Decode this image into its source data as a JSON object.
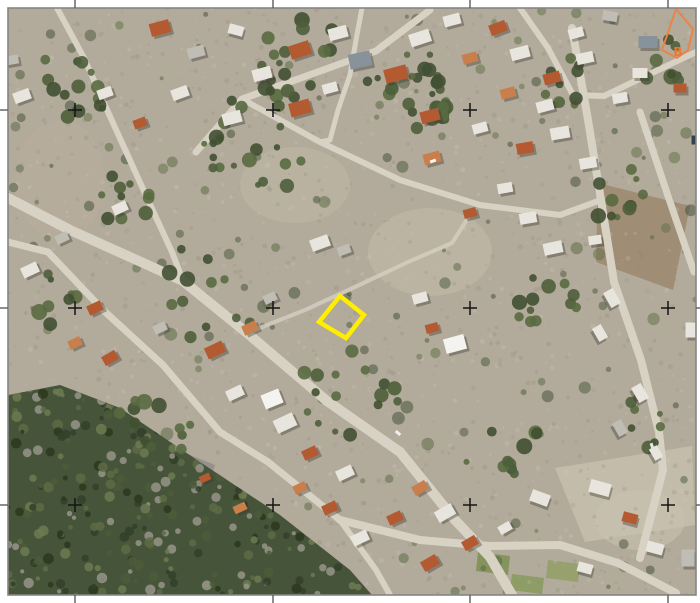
{
  "canvas": {
    "width": 700,
    "height": 603,
    "background": "#ffffff"
  },
  "frame": {
    "x": 8,
    "y": 8,
    "width": 688,
    "height": 587,
    "border_color": "#858585",
    "border_width": 1.6,
    "tick_color": "#5c5c5c",
    "tick_width": 1.4,
    "tick_len": 8
  },
  "grid": {
    "cross_color": "#151515",
    "cross_half": 7,
    "cross_width": 1.5,
    "xs": [
      75,
      273,
      470,
      668
    ],
    "ys": [
      110,
      308,
      505
    ]
  },
  "overlays": {
    "parcel": {
      "points": [
        [
          340,
          296
        ],
        [
          364,
          315
        ],
        [
          346,
          338
        ],
        [
          319,
          322
        ]
      ],
      "color": "#ffee00",
      "stroke_width": 4.5
    },
    "zone": {
      "points": [
        [
          676,
          9
        ],
        [
          693,
          29
        ],
        [
          688,
          50
        ],
        [
          677,
          58
        ],
        [
          662,
          50
        ]
      ],
      "color": "#ee8240",
      "stroke_width": 2,
      "label": "B",
      "label_x": 678,
      "label_y": 56,
      "label_color": "#e87a30",
      "label_size": 12
    }
  },
  "palette": {
    "terrain": "#b2aa9a",
    "road": "#d8d2c4",
    "forest": "#46543a",
    "tree_greens": [
      "#4e5e3b",
      "#415032",
      "#596a40"
    ],
    "shadow": "#3c3c34",
    "roofs": {
      "orange": "#b45a31",
      "orange2": "#c97f4b",
      "white": "#e7e5de",
      "white_bright": "#f4f3ef",
      "gray": "#bfbdb4",
      "gray_blue": "#87929b",
      "dark": "#6e6e68"
    }
  },
  "texture": {
    "ground": {
      "seed": 11,
      "count": 1500,
      "rmin": 0.7,
      "rmax": 2.6,
      "opacity": 0.22,
      "colors": [
        "#97907e",
        "#cdc7b8",
        "#8b8470",
        "#d6d0c2",
        "#7d8a68"
      ]
    },
    "greens": {
      "seed": 23,
      "count": 170,
      "rmin": 2,
      "rmax": 6.5,
      "opacity": 0.5,
      "colors": [
        "#55663f",
        "#47573a",
        "#5f7046",
        "#3e4c33"
      ]
    },
    "forest": {
      "seed": 5,
      "count": 420,
      "rmin": 2,
      "rmax": 5.5,
      "opacity": 0.85,
      "colors": [
        "#33402a",
        "#4c5c3a",
        "#5d6b45",
        "#97948a",
        "#2b381f",
        "#6d7b52"
      ]
    }
  },
  "forest_polygon": [
    [
      8,
      395
    ],
    [
      60,
      385
    ],
    [
      120,
      408
    ],
    [
      200,
      462
    ],
    [
      280,
      515
    ],
    [
      350,
      570
    ],
    [
      372,
      595
    ],
    [
      8,
      595
    ]
  ],
  "forest_bbox": [
    8,
    380,
    380,
    595
  ],
  "fields": [
    {
      "type": "ellipse",
      "cx": 60,
      "cy": 180,
      "rx": 45,
      "ry": 60,
      "fill": "#b7ae9c",
      "op": 0.5
    },
    {
      "type": "ellipse",
      "cx": 295,
      "cy": 185,
      "rx": 55,
      "ry": 38,
      "fill": "#c1b9a7",
      "op": 0.5
    },
    {
      "type": "ellipse",
      "cx": 430,
      "cy": 252,
      "rx": 62,
      "ry": 44,
      "fill": "#c3bbaa",
      "op": 0.55
    },
    {
      "type": "poly",
      "pts": [
        [
          598,
          183
        ],
        [
          690,
          206
        ],
        [
          673,
          290
        ],
        [
          596,
          262
        ]
      ],
      "fill": "#9d8a72",
      "op": 0.9
    },
    {
      "type": "poly",
      "pts": [
        [
          555,
          468
        ],
        [
          692,
          446
        ],
        [
          695,
          525
        ],
        [
          585,
          542
        ]
      ],
      "fill": "#c6bfae",
      "op": 0.85
    },
    {
      "type": "ellipse",
      "cx": 640,
      "cy": 520,
      "rx": 45,
      "ry": 30,
      "fill": "#c9c2b1",
      "op": 0.6
    },
    {
      "type": "poly",
      "pts": [
        [
          120,
          427
        ],
        [
          215,
          465
        ],
        [
          185,
          555
        ],
        [
          95,
          515
        ]
      ],
      "fill": "#5d6670",
      "op": 0.35
    },
    {
      "type": "poly",
      "pts": [
        [
          478,
          552
        ],
        [
          510,
          556
        ],
        [
          508,
          575
        ],
        [
          476,
          571
        ]
      ],
      "fill": "#7f9158",
      "op": 0.9
    },
    {
      "type": "poly",
      "pts": [
        [
          512,
          574
        ],
        [
          544,
          578
        ],
        [
          542,
          594
        ],
        [
          510,
          590
        ]
      ],
      "fill": "#8a9a60",
      "op": 0.9
    },
    {
      "type": "poly",
      "pts": [
        [
          548,
          560
        ],
        [
          580,
          564
        ],
        [
          578,
          582
        ],
        [
          546,
          578
        ]
      ],
      "fill": "#90a066",
      "op": 0.85
    }
  ],
  "roads": [
    {
      "pts": [
        [
          8,
          198
        ],
        [
          70,
          230
        ],
        [
          130,
          257
        ],
        [
          183,
          281
        ],
        [
          247,
          333
        ],
        [
          327,
          401
        ],
        [
          400,
          452
        ],
        [
          455,
          520
        ],
        [
          490,
          557
        ],
        [
          512,
          595
        ]
      ],
      "w": 10
    },
    {
      "pts": [
        [
          8,
          242
        ],
        [
          48,
          252
        ],
        [
          103,
          310
        ],
        [
          163,
          365
        ],
        [
          220,
          432
        ],
        [
          268,
          462
        ],
        [
          340,
          520
        ]
      ],
      "w": 7
    },
    {
      "pts": [
        [
          340,
          520
        ],
        [
          420,
          540
        ],
        [
          490,
          546
        ],
        [
          560,
          545
        ],
        [
          618,
          563
        ],
        [
          676,
          593
        ]
      ],
      "w": 8
    },
    {
      "pts": [
        [
          340,
          520
        ],
        [
          376,
          570
        ],
        [
          390,
          595
        ]
      ],
      "w": 6
    },
    {
      "pts": [
        [
          196,
          152
        ],
        [
          242,
          99
        ],
        [
          312,
          74
        ],
        [
          376,
          51
        ],
        [
          430,
          10
        ]
      ],
      "w": 7
    },
    {
      "pts": [
        [
          57,
          8
        ],
        [
          84,
          58
        ],
        [
          108,
          112
        ],
        [
          148,
          200
        ],
        [
          172,
          252
        ],
        [
          183,
          281
        ]
      ],
      "w": 6
    },
    {
      "pts": [
        [
          572,
          28
        ],
        [
          588,
          120
        ],
        [
          601,
          200
        ],
        [
          614,
          282
        ],
        [
          641,
          360
        ],
        [
          659,
          432
        ],
        [
          663,
          470
        ],
        [
          650,
          520
        ],
        [
          640,
          558
        ]
      ],
      "w": 8
    },
    {
      "pts": [
        [
          640,
          112
        ],
        [
          668,
          196
        ],
        [
          694,
          272
        ]
      ],
      "w": 7
    },
    {
      "pts": [
        [
          604,
          96
        ],
        [
          654,
          72
        ],
        [
          696,
          52
        ]
      ],
      "w": 6
    },
    {
      "pts": [
        [
          520,
          8
        ],
        [
          548,
          48
        ],
        [
          573,
          95
        ],
        [
          604,
          96
        ]
      ],
      "w": 6
    },
    {
      "pts": [
        [
          242,
          99
        ],
        [
          320,
          142
        ],
        [
          400,
          180
        ],
        [
          480,
          205
        ],
        [
          560,
          215
        ],
        [
          601,
          200
        ]
      ],
      "w": 6
    },
    {
      "pts": [
        [
          247,
          333
        ],
        [
          305,
          310
        ],
        [
          355,
          287
        ],
        [
          408,
          262
        ],
        [
          452,
          243
        ],
        [
          470,
          215
        ]
      ],
      "w": 4,
      "o": 0.75
    },
    {
      "pts": [
        [
          362,
          8
        ],
        [
          356,
          40
        ],
        [
          350,
          75
        ],
        [
          338,
          110
        ],
        [
          330,
          140
        ],
        [
          320,
          142
        ]
      ],
      "w": 5
    }
  ],
  "tree_clusters": [
    {
      "x": 250,
      "y": 135,
      "n": 26,
      "s": 95
    },
    {
      "x": 420,
      "y": 95,
      "n": 22,
      "s": 85
    },
    {
      "x": 80,
      "y": 80,
      "n": 14,
      "s": 75
    },
    {
      "x": 545,
      "y": 295,
      "n": 12,
      "s": 75
    },
    {
      "x": 350,
      "y": 400,
      "n": 16,
      "s": 95
    },
    {
      "x": 620,
      "y": 195,
      "n": 10,
      "s": 60
    },
    {
      "x": 195,
      "y": 300,
      "n": 12,
      "s": 85
    },
    {
      "x": 150,
      "y": 430,
      "n": 12,
      "s": 70
    },
    {
      "x": 505,
      "y": 440,
      "n": 10,
      "s": 65
    },
    {
      "x": 300,
      "y": 55,
      "n": 14,
      "s": 75
    },
    {
      "x": 565,
      "y": 75,
      "n": 10,
      "s": 60
    },
    {
      "x": 645,
      "y": 420,
      "n": 8,
      "s": 55
    },
    {
      "x": 665,
      "y": 60,
      "n": 8,
      "s": 45
    },
    {
      "x": 438,
      "y": 112,
      "n": 16,
      "s": 16
    },
    {
      "x": 130,
      "y": 200,
      "n": 10,
      "s": 60
    },
    {
      "x": 60,
      "y": 300,
      "n": 8,
      "s": 55
    }
  ],
  "houses": [
    [
      160,
      28,
      20,
      13,
      -15,
      "orange"
    ],
    [
      196,
      52,
      17,
      11,
      -15,
      "gray"
    ],
    [
      236,
      30,
      15,
      10,
      15,
      "white"
    ],
    [
      262,
      74,
      19,
      12,
      -15,
      "white"
    ],
    [
      300,
      50,
      21,
      14,
      -18,
      "orange"
    ],
    [
      338,
      33,
      19,
      12,
      -15,
      "white"
    ],
    [
      360,
      60,
      22,
      15,
      -12,
      "gray_blue"
    ],
    [
      396,
      74,
      23,
      14,
      -15,
      "orange"
    ],
    [
      420,
      38,
      21,
      13,
      -18,
      "white"
    ],
    [
      452,
      20,
      17,
      11,
      -15,
      "white"
    ],
    [
      470,
      58,
      15,
      10,
      -15,
      "orange2"
    ],
    [
      498,
      28,
      17,
      11,
      -20,
      "orange"
    ],
    [
      520,
      53,
      19,
      12,
      -15,
      "white"
    ],
    [
      552,
      78,
      17,
      11,
      -15,
      "orange"
    ],
    [
      576,
      33,
      15,
      10,
      -15,
      "white"
    ],
    [
      610,
      16,
      15,
      10,
      10,
      "gray"
    ],
    [
      648,
      42,
      19,
      12,
      0,
      "gray_blue"
    ],
    [
      640,
      73,
      15,
      10,
      0,
      "white"
    ],
    [
      508,
      93,
      15,
      10,
      -15,
      "orange2"
    ],
    [
      545,
      106,
      17,
      11,
      -15,
      "white"
    ],
    [
      585,
      58,
      17,
      11,
      -12,
      "white"
    ],
    [
      620,
      98,
      15,
      10,
      -10,
      "white"
    ],
    [
      680,
      88,
      13,
      9,
      0,
      "orange"
    ],
    [
      22,
      96,
      17,
      11,
      -20,
      "white"
    ],
    [
      105,
      93,
      15,
      10,
      -20,
      "white"
    ],
    [
      140,
      123,
      13,
      9,
      -20,
      "orange"
    ],
    [
      180,
      93,
      17,
      11,
      -20,
      "white"
    ],
    [
      232,
      118,
      19,
      12,
      -15,
      "white"
    ],
    [
      120,
      208,
      15,
      10,
      -25,
      "white"
    ],
    [
      62,
      238,
      13,
      9,
      -25,
      "gray"
    ],
    [
      12,
      60,
      13,
      9,
      -10,
      "gray"
    ],
    [
      300,
      108,
      21,
      14,
      -15,
      "orange"
    ],
    [
      330,
      88,
      15,
      10,
      -15,
      "white"
    ],
    [
      430,
      116,
      19,
      12,
      -15,
      "orange"
    ],
    [
      480,
      128,
      15,
      10,
      -15,
      "white"
    ],
    [
      432,
      158,
      17,
      11,
      -15,
      "orange2"
    ],
    [
      525,
      148,
      17,
      11,
      -10,
      "orange"
    ],
    [
      560,
      133,
      19,
      12,
      -10,
      "white"
    ],
    [
      588,
      163,
      17,
      11,
      -10,
      "white"
    ],
    [
      505,
      188,
      15,
      10,
      -10,
      "white"
    ],
    [
      528,
      218,
      17,
      11,
      -10,
      "white"
    ],
    [
      553,
      248,
      19,
      12,
      -12,
      "white"
    ],
    [
      470,
      213,
      13,
      9,
      -15,
      "orange"
    ],
    [
      30,
      270,
      17,
      11,
      -25,
      "white"
    ],
    [
      95,
      308,
      15,
      10,
      -25,
      "orange"
    ],
    [
      75,
      343,
      13,
      9,
      -25,
      "orange2"
    ],
    [
      110,
      358,
      15,
      10,
      -30,
      "orange"
    ],
    [
      160,
      328,
      13,
      9,
      -25,
      "gray"
    ],
    [
      215,
      350,
      19,
      12,
      -25,
      "orange"
    ],
    [
      250,
      328,
      15,
      10,
      -25,
      "orange2"
    ],
    [
      270,
      298,
      13,
      9,
      -25,
      "gray"
    ],
    [
      235,
      393,
      17,
      11,
      -25,
      "white"
    ],
    [
      285,
      423,
      21,
      14,
      -25,
      "white"
    ],
    [
      320,
      243,
      19,
      12,
      -20,
      "white"
    ],
    [
      344,
      250,
      13,
      9,
      -20,
      "gray"
    ],
    [
      272,
      399,
      19,
      15,
      -22,
      "white_bright"
    ],
    [
      420,
      298,
      15,
      10,
      -15,
      "white"
    ],
    [
      455,
      344,
      21,
      15,
      -15,
      "white_bright"
    ],
    [
      432,
      328,
      13,
      9,
      -15,
      "orange"
    ],
    [
      612,
      298,
      17,
      11,
      60,
      "white"
    ],
    [
      600,
      333,
      15,
      10,
      60,
      "white"
    ],
    [
      640,
      393,
      17,
      11,
      60,
      "white"
    ],
    [
      620,
      428,
      15,
      10,
      60,
      "gray"
    ],
    [
      656,
      453,
      13,
      9,
      60,
      "white"
    ],
    [
      691,
      330,
      11,
      15,
      0,
      "white"
    ],
    [
      595,
      240,
      13,
      9,
      -8,
      "white"
    ],
    [
      310,
      453,
      15,
      10,
      -25,
      "orange"
    ],
    [
      345,
      473,
      17,
      11,
      -25,
      "white"
    ],
    [
      300,
      488,
      13,
      9,
      -25,
      "orange2"
    ],
    [
      330,
      508,
      15,
      10,
      -25,
      "orange"
    ],
    [
      360,
      538,
      17,
      11,
      -25,
      "white"
    ],
    [
      395,
      518,
      15,
      10,
      -25,
      "orange"
    ],
    [
      420,
      488,
      15,
      10,
      -30,
      "orange2"
    ],
    [
      445,
      513,
      19,
      12,
      -30,
      "white"
    ],
    [
      470,
      543,
      15,
      10,
      -30,
      "orange"
    ],
    [
      430,
      563,
      17,
      11,
      -30,
      "orange"
    ],
    [
      505,
      528,
      13,
      9,
      -30,
      "white"
    ],
    [
      540,
      498,
      19,
      12,
      20,
      "white"
    ],
    [
      600,
      488,
      21,
      13,
      15,
      "white"
    ],
    [
      630,
      518,
      15,
      10,
      15,
      "orange"
    ],
    [
      655,
      548,
      17,
      11,
      15,
      "white"
    ],
    [
      688,
      558,
      13,
      17,
      0,
      "gray"
    ],
    [
      585,
      568,
      15,
      10,
      15,
      "white"
    ],
    [
      240,
      508,
      13,
      8,
      -25,
      "orange2"
    ],
    [
      205,
      478,
      11,
      7,
      -25,
      "orange"
    ]
  ],
  "cars": [
    [
      433,
      161,
      6,
      3,
      -20,
      "#f8f8f6"
    ],
    [
      398,
      433,
      6,
      3,
      40,
      "#eeeeec"
    ],
    [
      652,
      446,
      6,
      3,
      70,
      "#e6e6e4"
    ],
    [
      694,
      140,
      5,
      9,
      0,
      "#33414e"
    ]
  ]
}
